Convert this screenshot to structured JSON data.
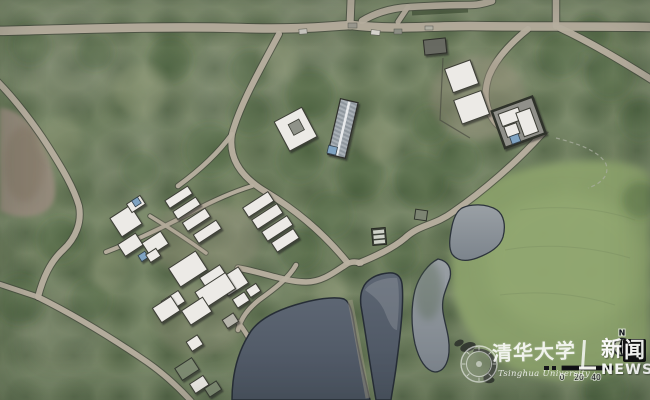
{
  "watermark": {
    "calligraphy": "清华大学",
    "university_name": "Tsinghua University",
    "news_logo": {
      "char1": "新",
      "char2": "闻",
      "text": "NEWS"
    }
  },
  "compass": {
    "north_label": "N"
  },
  "scale_bar": {
    "tick_labels": [
      "0",
      "20",
      "40"
    ]
  },
  "colors": {
    "vegetation": "#798969",
    "meadow": "#8ca26c",
    "dirt_patch": "#958a7c",
    "road": "#b9b1a1",
    "water_dark": "#566070",
    "water_light": "#8b9196",
    "building_white": "#eceae6",
    "building_accent_blue": "#7fa3c2",
    "news_logo_box": "#0b0b0e",
    "watermark_white": "#ffffff"
  }
}
